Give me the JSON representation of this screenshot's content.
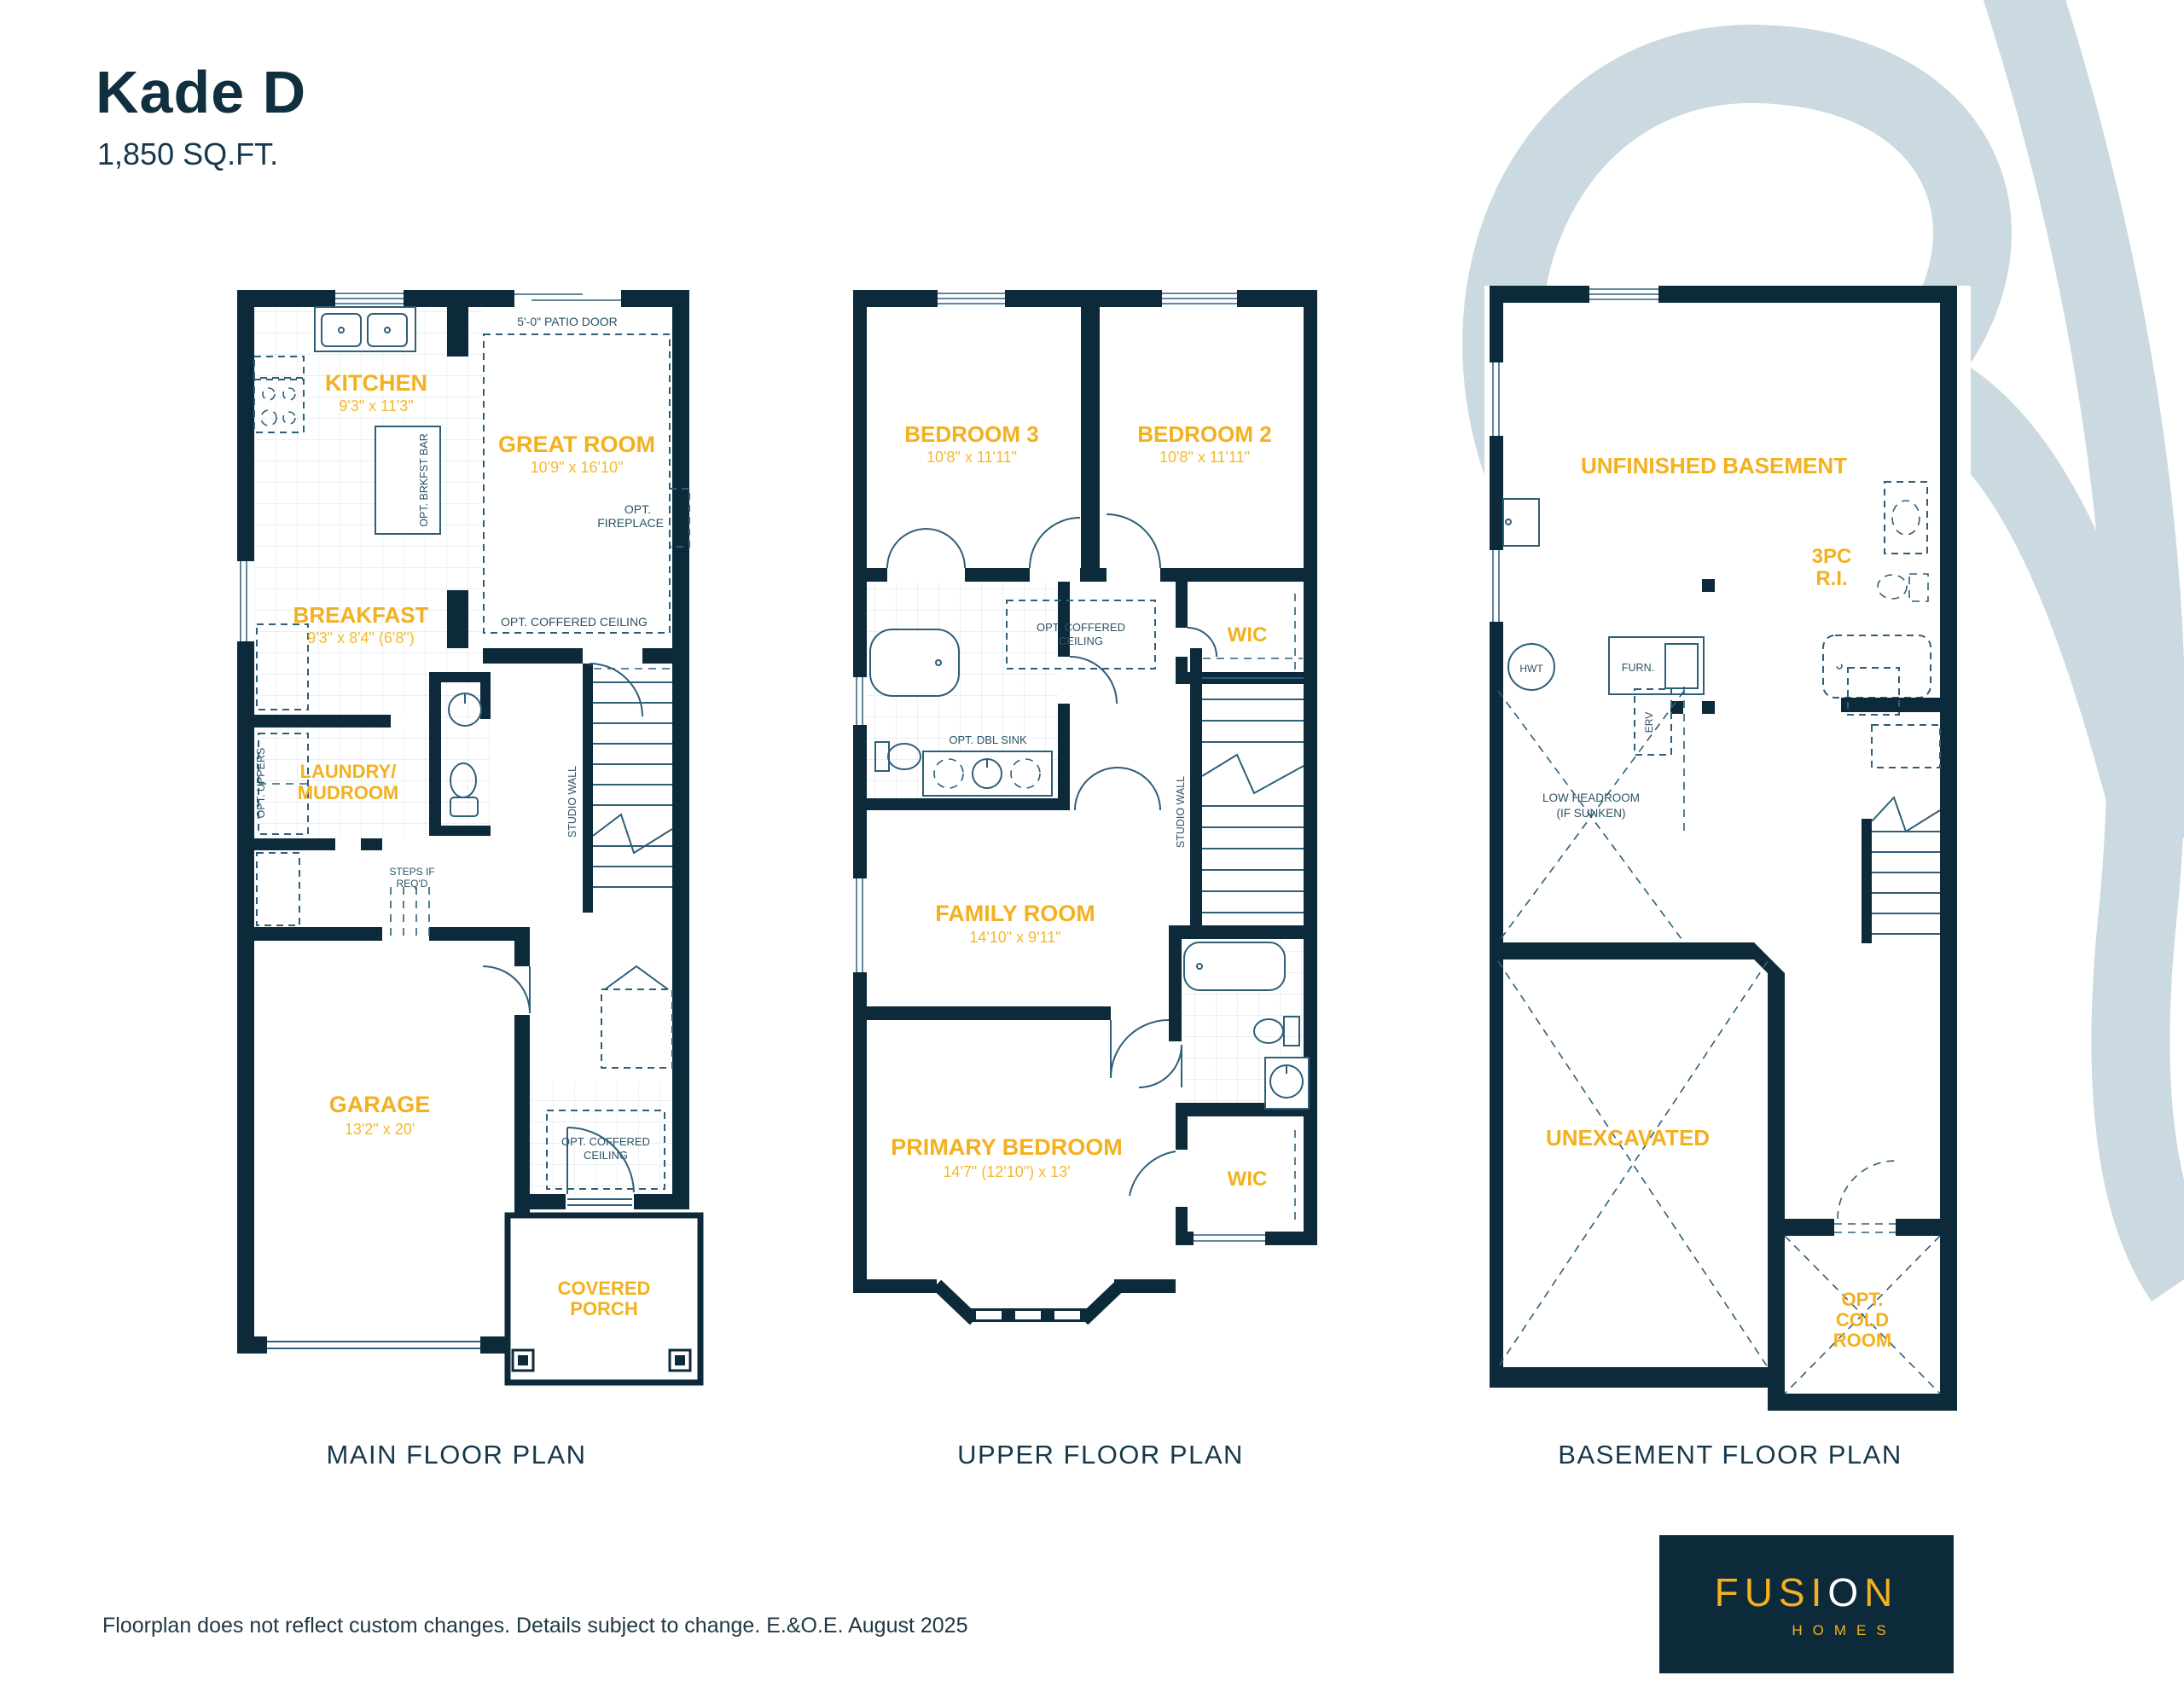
{
  "header": {
    "title": "Kade D",
    "sqft": "1,850 SQ.FT."
  },
  "footer": {
    "disclaimer": "Floorplan does not reflect custom changes. Details subject to change. E.&O.E. August 2025",
    "logo": {
      "f1": "FUSI",
      "o": "O",
      "n": "N",
      "homes": "HOMES"
    }
  },
  "colors": {
    "navy": "#0D2A3A",
    "yellow": "#F3B01F",
    "line": "#2E5E78",
    "swoosh": "#CBD9E1"
  },
  "plans": {
    "main": {
      "title": "MAIN FLOOR PLAN",
      "kitchen": "KITCHEN",
      "kitchen_dims": "9'3\" x 11'3\"",
      "great": "GREAT ROOM",
      "great_dims": "10'9\" x 16'10\"",
      "patio_door": "5'-0\" PATIO DOOR",
      "brkfst_bar": "OPT. BRKFST BAR",
      "fireplace1": "OPT.",
      "fireplace2": "FIREPLACE",
      "coffered_great": "OPT. COFFERED CEILING",
      "breakfast": "BREAKFAST",
      "breakfast_dims": "9'3\" x 8'4\" (6'8\")",
      "laundry1": "LAUNDRY/",
      "laundry2": "MUDROOM",
      "opt_uppers": "OPT. UPPERS",
      "steps1": "STEPS IF",
      "steps2": "REQ'D",
      "studio_wall": "STUDIO WALL",
      "garage": "GARAGE",
      "garage_dims": "13'2\" x 20'",
      "coffered_foyer1": "OPT. COFFERED",
      "coffered_foyer2": "CEILING",
      "porch1": "COVERED",
      "porch2": "PORCH"
    },
    "upper": {
      "title": "UPPER FLOOR PLAN",
      "bed3": "BEDROOM 3",
      "bed3_dims": "10'8\" x 11'11\"",
      "bed2": "BEDROOM 2",
      "bed2_dims": "10'8\" x 11'11\"",
      "coffered1": "OPT. COFFERED",
      "coffered2": "CEILING",
      "wic": "WIC",
      "dbl_sink": "OPT. DBL SINK",
      "family": "FAMILY ROOM",
      "family_dims": "14'10\" x 9'11\"",
      "studio_wall": "STUDIO WALL",
      "primary": "PRIMARY BEDROOM",
      "primary_dims": "14'7\" (12'10\") x 13'",
      "wic2": "WIC"
    },
    "basement": {
      "title": "BASEMENT FLOOR PLAN",
      "unfinished": "UNFINISHED BASEMENT",
      "threepc1": "3PC",
      "threepc2": "R.I.",
      "hwt": "HWT",
      "furn": "FURN.",
      "erv": "ERV",
      "low1": "LOW HEADROOM",
      "low2": "(IF SUNKEN)",
      "unexcavated": "UNEXCAVATED",
      "cold1": "OPT.",
      "cold2": "COLD",
      "cold3": "ROOM"
    }
  }
}
